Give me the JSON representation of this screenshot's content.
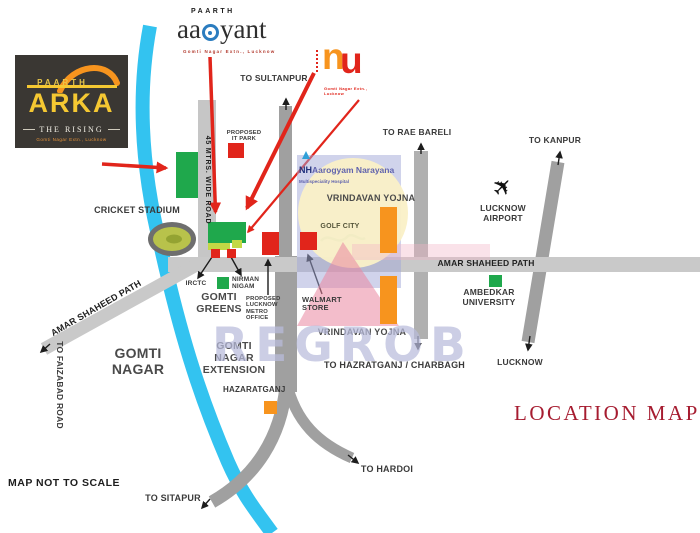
{
  "title": "LOCATION MAP",
  "note": "MAP NOT TO SCALE",
  "watermark": "REGROB",
  "logos": {
    "arka": {
      "brand": "PAARTH",
      "devanagari": "अर्का",
      "display_latin": "ARKA",
      "tagline": "THE RISING",
      "location": "Gomti Nagar Extn., Lucknow"
    },
    "aadyant": {
      "brand": "PAARTH",
      "name_left": "aa",
      "name_right": "yant",
      "location": "Gomti Nagar Extn., Lucknow"
    },
    "nu": {
      "n": "n",
      "u": "u",
      "location": "Gomti Nagar Extn., Lucknow"
    }
  },
  "rivers": {
    "top_label": "GOMTI RIVER",
    "bottom_label": "GOMTI RIVER"
  },
  "roads": {
    "wide_road": "45 MTRS. WIDE ROAD",
    "asp_diagonal": "AMAR SHAHEED PATH",
    "asp_right": "AMAR SHAHEED PATH"
  },
  "destinations": {
    "sultanpur": "TO SULTANPUR",
    "rae_bareli": "TO RAE BARELI",
    "kanpur": "TO KANPUR",
    "hazratganj": "TO HAZRATGANJ / CHARBAGH",
    "lucknow": "LUCKNOW",
    "hardoi": "TO HARDOI",
    "sitapur": "TO SITAPUR",
    "faizabad": "TO FAIZABAD ROAD"
  },
  "places": {
    "cricket_stadium": "CRICKET STADIUM",
    "it_park": "PROPOSED IT PARK",
    "hospital_nh": "NH",
    "hospital_name": "Aarogyam Narayana",
    "hospital_sub": "Multispeciality Hospital",
    "vrindavan_1": "VRINDAVAN YOJNA",
    "vrindavan_2": "VRINDAVAN YOJNA",
    "golf_city": "GOLF CITY",
    "airport": "LUCKNOW AIRPORT",
    "irctc": "IRCTC",
    "nirman_nigam": "NIRMAN NIGAM",
    "gomti_greens": "GOMTI GREENS",
    "metro_office": "PROPOSED LUCKNOW METRO OFFICE",
    "walmart": "WALMART STORE",
    "gomti_nagar_ext": "GOMTI NAGAR EXTENSION",
    "hazaratganj_area": "HAZARATGANJ",
    "gomti_nagar": "GOMTI NAGAR",
    "ambedkar": "AMBEDKAR UNIVERSITY"
  },
  "colors": {
    "river": "#33c3f0",
    "road": "#a3a3a3",
    "road_light": "#c9c9c9",
    "green_marker": "#1fa84c",
    "red_marker": "#e1251b",
    "orange_marker": "#f7941e",
    "arka_bg": "#3a3733",
    "arka_yellow": "#f5c832",
    "title_red": "#a61c30",
    "watermark_purple": "#b9bcdc"
  }
}
